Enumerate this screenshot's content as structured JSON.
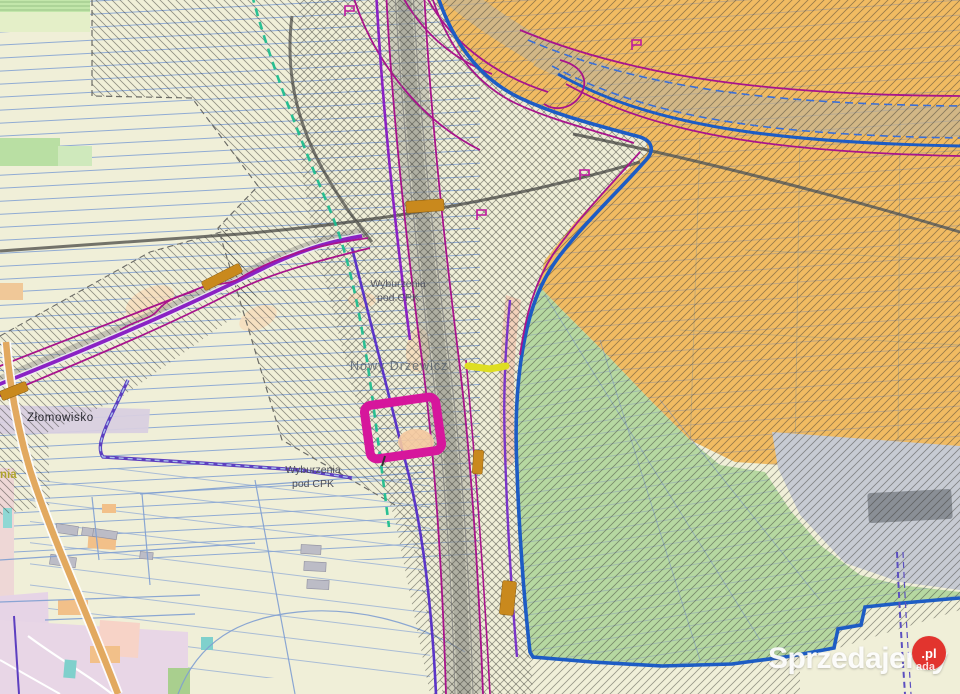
{
  "map": {
    "labels": {
      "zlomowisko": "Złomowisko",
      "wyburzenia_upper": {
        "line1": "Wyburzenia",
        "line2": "pod CPK"
      },
      "wyburzenia_lower": {
        "line1": "Wyburzenia",
        "line2": "pod CPK"
      },
      "nowy_drzewicz": "Nowy Drzewicz",
      "left_edge_fragment": "nia"
    },
    "highlight": {
      "shape": "rotated-rectangle-outline",
      "color": "#d6169c"
    },
    "colors": {
      "background_fields": "#f0efd8",
      "zone_orange": "#f1bb62",
      "zone_green": "#b6d8a1",
      "zone_gray": "#c7cbd3",
      "boundary_blue": "#1d5cc4",
      "road_magenta": "#a8148c",
      "road_purple": "#8a22c4",
      "line_indigo": "#5b35c8",
      "dashed_teal": "#1fbd8f",
      "bridge_ochre": "#c9891d",
      "road_orange": "#e2a95f",
      "parcel_blue": "#7f9fd2"
    }
  },
  "watermark": {
    "brand": "Sprzedajemy",
    "badge": ".pl",
    "suffix": "ada",
    "badge_color": "#e2342e"
  }
}
